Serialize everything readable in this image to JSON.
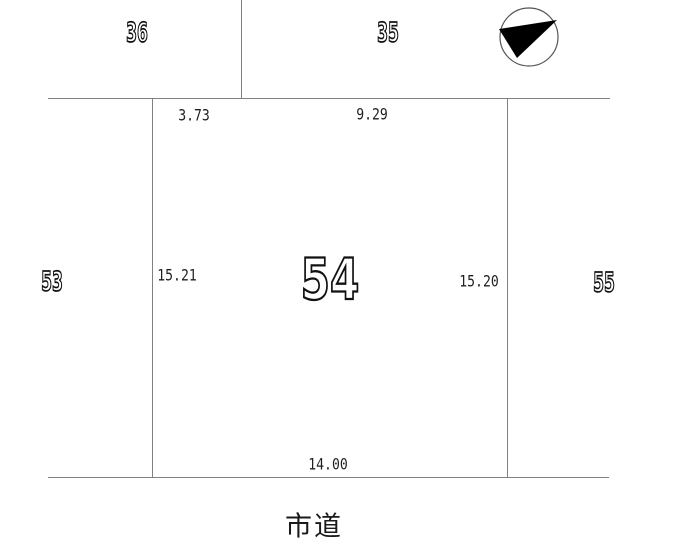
{
  "drawing": {
    "parcel_number": "54",
    "neighbors": {
      "top_left": "36",
      "top_right": "35",
      "left": "53",
      "right": "55"
    },
    "dimensions": {
      "top_left": "3.73",
      "top_right": "9.29",
      "left": "15.21",
      "right": "15.20",
      "bottom": "14.00"
    },
    "road_label": "市道",
    "compass_icon": "north-arrow",
    "colors": {
      "line": "#808080",
      "text": "#1f1f1f",
      "outline_text": "#111111",
      "background": "#ffffff"
    }
  }
}
